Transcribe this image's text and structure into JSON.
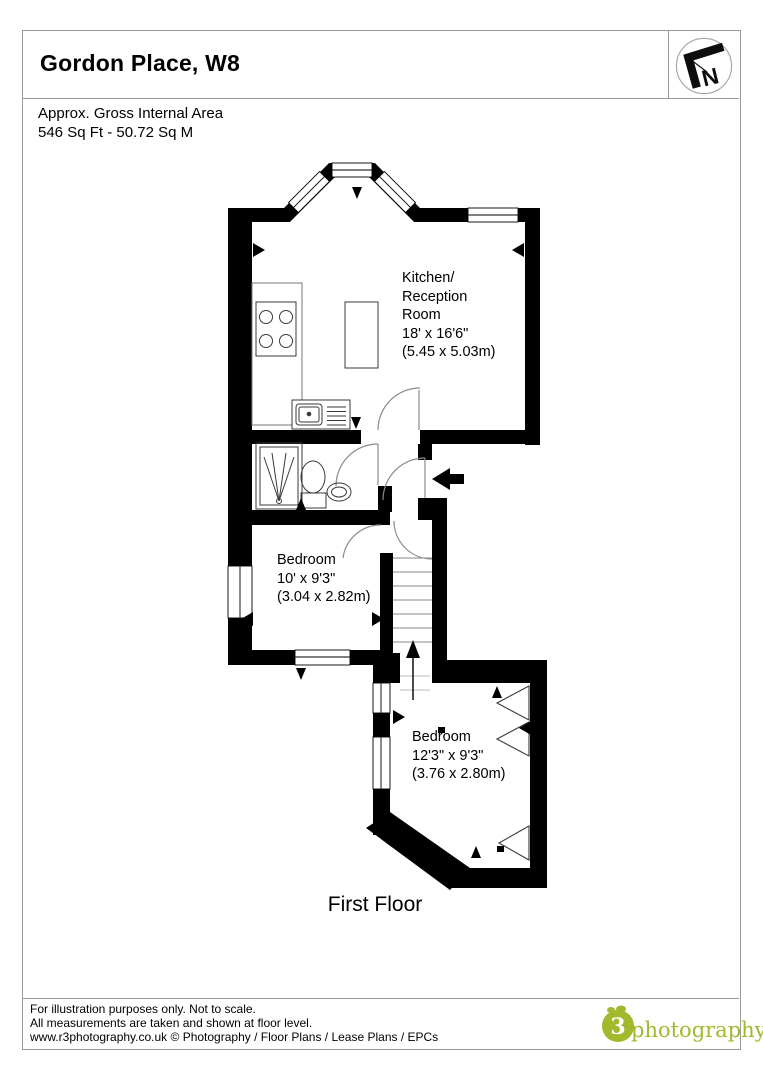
{
  "header": {
    "title": "Gordon Place, W8",
    "area_text": "Approx. Gross Internal Area\n546 Sq Ft  -  50.72 Sq M"
  },
  "compass": {
    "letter": "N"
  },
  "rooms": {
    "kitchen": {
      "name": "Kitchen/\nReception\nRoom",
      "imperial": "18' x 16'6\"",
      "metric": "(5.45 x 5.03m)"
    },
    "bedroom1": {
      "name": "Bedroom",
      "imperial": "10' x 9'3\"",
      "metric": "(3.04 x 2.82m)"
    },
    "bedroom2": {
      "name": "Bedroom",
      "imperial": "12'3\" x 9'3\"",
      "metric": "(3.76 x 2.80m)"
    }
  },
  "floor_label": "First Floor",
  "footer": {
    "line1": "For illustration purposes only. Not to scale.",
    "line2": "All measurements are taken and shown at floor level.",
    "line3": "www.r3photography.co.uk © Photography / Floor Plans / Lease Plans / EPCs",
    "logo_mark": "3",
    "logo_word": "photography"
  },
  "colors": {
    "wall": "#000000",
    "logo_green": "#a3b82c",
    "border_gray": "#9a9a9a"
  }
}
